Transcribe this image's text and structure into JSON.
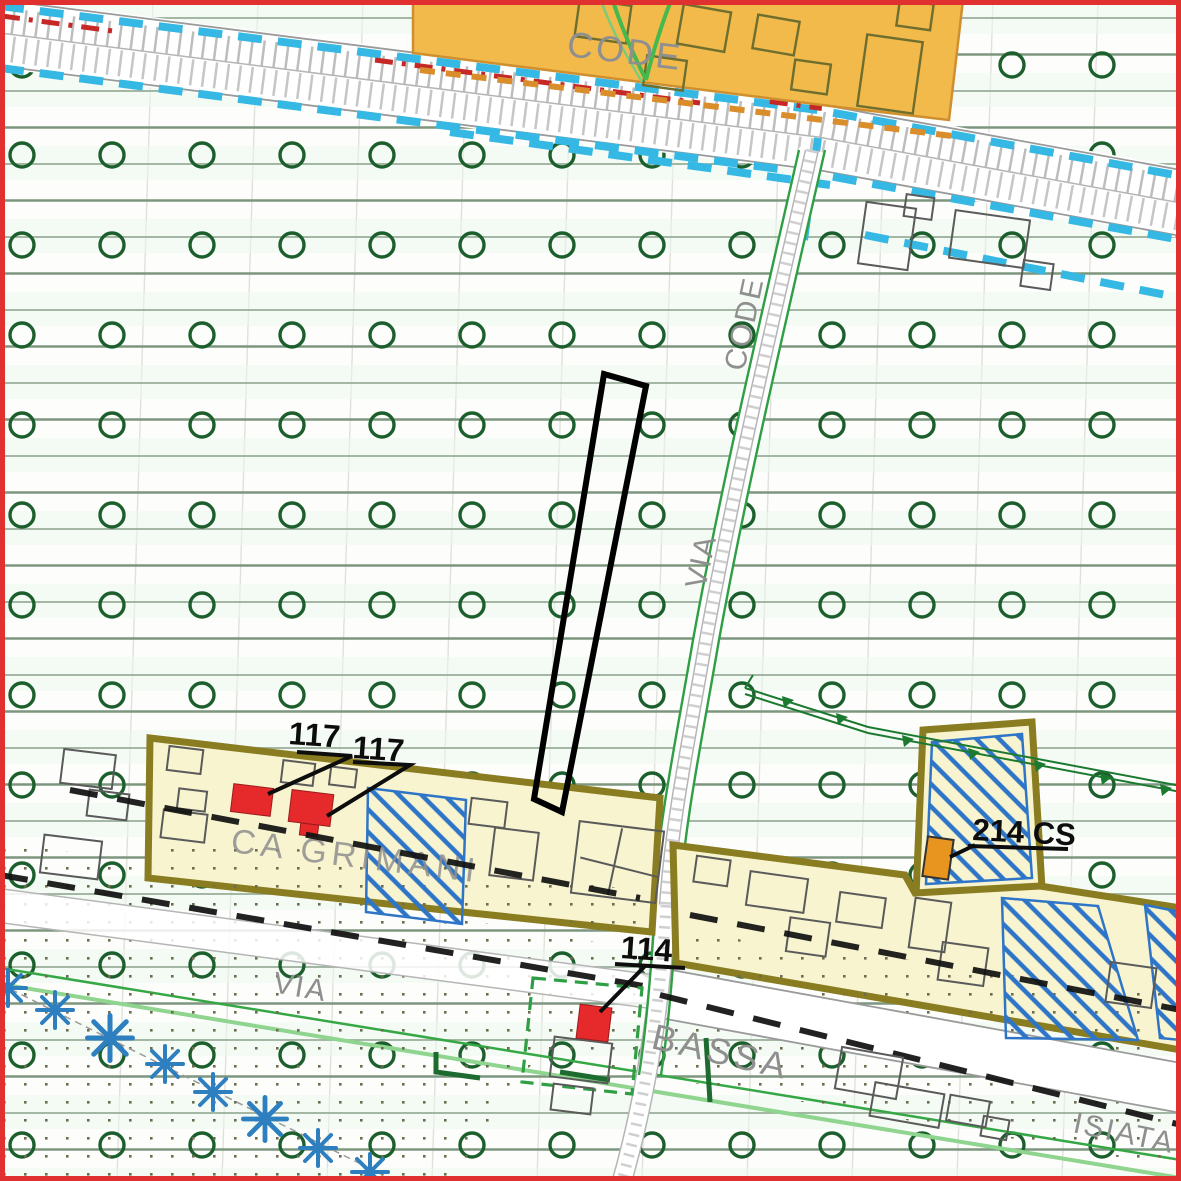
{
  "map_labels": {
    "code_top": "CODE",
    "via_code_word1": "VIA",
    "via_code_word2": "CODE",
    "ca_grimani": "CA GRIMANI",
    "via_bassa_word1": "VIA",
    "via_bassa_word2": "BASSA",
    "isiata": "ISIATA"
  },
  "feature_labels": {
    "building_117_a": "117",
    "building_117_b": "117",
    "building_114": "114",
    "building_214_cs": "214 CS"
  },
  "legend_semantics": {
    "green_circle_pattern": "agricultural-zone-symbol",
    "blue_hatch": "restricted/constraint-area-hatch",
    "red_fill_building": "numbered-heritage-building",
    "blue_star": "tree-row-symbol",
    "cyan_dashes": "infrastructure-buffer-line",
    "black_dashes": "road-boundary-line"
  },
  "colors": {
    "frame_red": "#e03030",
    "agricultural_circle_green": "#1c5f2d",
    "grid_line_green": "#8aa48a",
    "bright_green": "#35a845",
    "orange_zone": "#f2b94b",
    "yellow_zone": "#f8f4cf",
    "zone_border_olive": "#8a7c20",
    "hatch_blue": "#2e75c8",
    "cyan_dash": "#35b8e3",
    "red_building": "#e62a2c",
    "orange_building": "#e8951f",
    "red_dash": "#c62828",
    "tan_dash": "#d98e2b",
    "label_gray": "#8f8f8f",
    "label_black": "#0d0d0d",
    "star_blue": "#2d7fc0"
  }
}
